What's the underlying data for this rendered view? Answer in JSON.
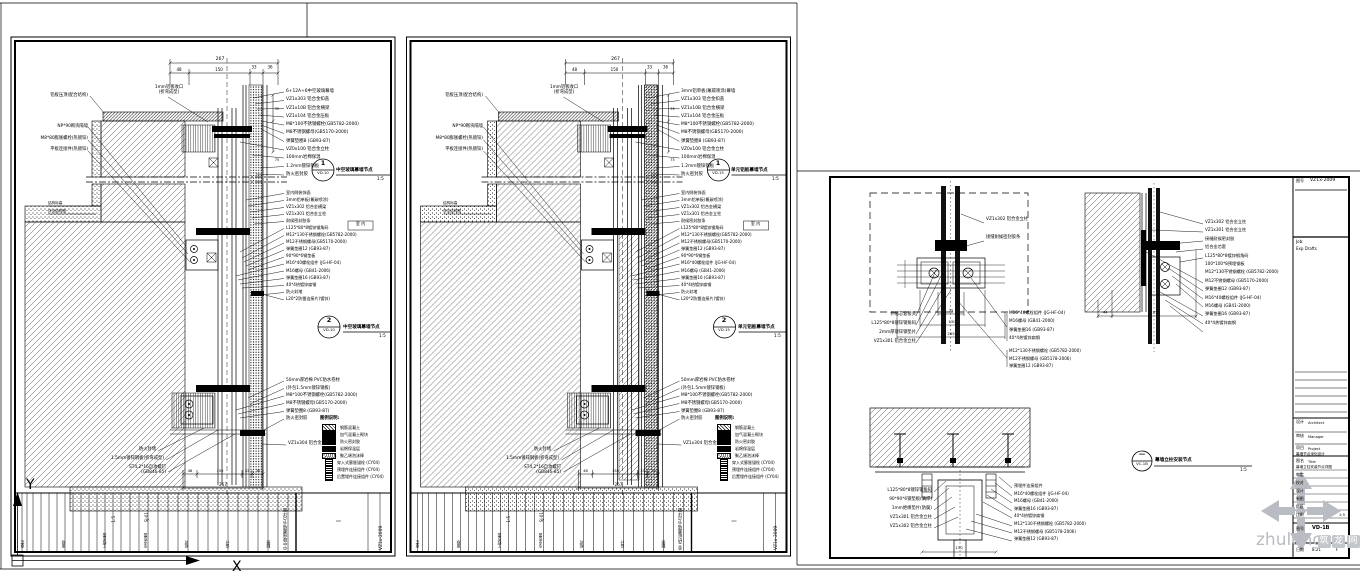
{
  "colors": {
    "line": "#000000",
    "watermark_grey": "#b9bcc2",
    "paper": "#ffffff"
  },
  "watermark": {
    "text": "zhulong",
    "suffix_chars": [
      "筑",
      "龙",
      "网"
    ]
  },
  "ucs": {
    "x_label": "X",
    "y_label": "Y"
  },
  "sheet_dims": {
    "top_total": "267",
    "segs": [
      "48",
      "150",
      "33",
      "36"
    ],
    "bottom_total": "267",
    "bottom_segs": [
      "48",
      "150",
      "33",
      "36"
    ],
    "side": [
      "35",
      "75"
    ]
  },
  "legend": {
    "title": "图例说明:",
    "items": [
      {
        "swatch": "hatch",
        "label": "钢筋混凝土"
      },
      {
        "swatch": "solid",
        "label": "加气混凝土砌块"
      },
      {
        "swatch": "solid",
        "label": "防火密封胶"
      },
      {
        "swatch": "solid",
        "label": "岩棉保温层"
      },
      {
        "swatch": "dots",
        "label": "聚乙烯泡沫棒"
      },
      {
        "swatch": "anchor",
        "label": "穿入式膨胀锚栓 (CY04)"
      },
      {
        "swatch": "anchor",
        "label": "预埋件连接组件 (CY04)"
      },
      {
        "swatch": "anchor",
        "label": "后置埋件连接组件 (CY04)"
      }
    ]
  },
  "sheet1": {
    "label_top": "1mm铝板收口\n(折弯成型)",
    "labels_left": [
      "铝板压顶(配合结构)",
      "NP*90砌块隔墙",
      "M8*80膨胀螺栓(热镀锌)",
      "平板连接件(热镀锌)"
    ],
    "labels_level": [
      "结构标高",
      "详见结构图"
    ],
    "labels_bottom": [
      "防火封堵",
      "1.5mm镀锌钢板(折弯成型)",
      "ST4.2*16自攻螺钉\n(GB846-85)"
    ],
    "labels_right_top": [
      "6+12A+6中空玻璃幕墙",
      "VZ1x303 铝合金扣盖",
      "VZ1x10B 铝合金横梁",
      "VZ1x104 铝合金压板",
      "M8*100不锈钢螺栓(GB5782-2000)",
      "M8不锈钢螺母(GB5170-2000)",
      "弹簧垫圈8 (GB93-87)",
      "VZ0x100 铝合金立柱",
      "100mm岩棉保温",
      "1.2mm镀锌钢板",
      "防火密封胶"
    ],
    "labels_right_mid": [
      "室内侧装饰面",
      "3mm铝单板(氟碳喷涂)",
      "VZ1x302 铝合金横梁",
      "VZ1x301 铝合金立柱",
      "耐候密封胶条",
      "L125*80*8镀锌钢角码",
      "M12*130不锈钢螺栓(GB5782-2000)",
      "M12不锈钢螺母(GB5170-2000)",
      "弹簧垫圈12 (GB93-87)",
      "90*90*6钢垫板",
      "M16*40螺栓组件 (JG-HF-04)",
      "M16螺母 (GB41-2006)",
      "弹簧垫圈16 (GB93-87)",
      "40*4热镀锌扁钢",
      "防火封堵",
      "L20*2防雷连接片(镀锌)"
    ],
    "labels_right_bottom": [
      "50mm厚岩棉 PVC防水卷材",
      "(外包1.5mm镀锌钢板)",
      "M8*100不锈钢螺栓(GB5782-2000)",
      "M8不锈钢螺母(GB5170-2000)",
      "弹簧垫圈8 (GB93-87)",
      "防火密封胶"
    ],
    "label_cap": "VZ1x304 铝合金扣盖",
    "room_tag": "室 内",
    "callouts": [
      {
        "num": "1",
        "ref": "VD-10",
        "title": "中空玻璃幕墙节点",
        "scale": "1:5"
      },
      {
        "num": "2",
        "ref": "VD-10",
        "title": "中空玻璃幕墙节点",
        "scale": "1:5"
      }
    ],
    "strip": {
      "fields": [
        "审定",
        "审核",
        "工程负责",
        "专业负责",
        "校对",
        "设计",
        "制图"
      ],
      "scale": "1:5",
      "code": "SJ-01",
      "title": "中空玻璃幕墙节点详图",
      "no": "VZ1x-2009"
    }
  },
  "sheet2": {
    "label_top": "1mm铝板收口\n(折弯成型)",
    "labels_left": [
      "铝板压顶(配合结构)",
      "NP*90砌块隔墙",
      "M8*80膨胀螺栓(热镀锌)",
      "平板连接件(热镀锌)"
    ],
    "labels_level": [
      "结构标高",
      "详见结构图"
    ],
    "labels_bottom": [
      "防火封堵",
      "1.5mm镀锌钢板(折弯成型)",
      "ST4.2*16自攻螺钉\n(GB846-85)"
    ],
    "labels_right_top": [
      "3mm铝单板(氟碳喷涂)幕墙",
      "VZ1x303 铝合金扣盖",
      "VZ1x10B 铝合金横梁",
      "VZ1x104 铝合金压板",
      "M8*100不锈钢螺栓(GB5782-2000)",
      "M8不锈钢螺母(GB5170-2000)",
      "弹簧垫圈8 (GB93-87)",
      "VZ0x100 铝合金立柱",
      "100mm岩棉保温",
      "1.2mm镀锌钢板",
      "防火密封胶"
    ],
    "labels_right_mid": [
      "室内侧装饰面",
      "3mm铝单板(氟碳喷涂)",
      "VZ1x302 铝合金横梁",
      "VZ1x301 铝合金立柱",
      "耐候密封胶条",
      "L125*80*8镀锌钢角码",
      "M12*130不锈钢螺栓(GB5782-2000)",
      "M12不锈钢螺母(GB5170-2000)",
      "弹簧垫圈12 (GB93-87)",
      "90*90*6钢垫板",
      "M16*40螺栓组件 (JG-HF-04)",
      "M16螺母 (GB41-2006)",
      "弹簧垫圈16 (GB93-87)",
      "40*4热镀锌扁钢",
      "防火封堵",
      "L20*2防雷连接片(镀锌)"
    ],
    "labels_right_bottom": [
      "50mm厚岩棉 PVC防水卷材",
      "(外包1.5mm镀锌钢板)",
      "M8*100不锈钢螺栓(GB5782-2000)",
      "M8不锈钢螺母(GB5170-2000)",
      "弹簧垫圈8 (GB93-87)",
      "防火密封胶"
    ],
    "label_cap": "VZ1x304 铝合金扣盖",
    "room_tag": "室 内",
    "callouts": [
      {
        "num": "1",
        "ref": "VD-15",
        "title": "单元铝板幕墙节点",
        "scale": "1:5"
      },
      {
        "num": "2",
        "ref": "VD-15",
        "title": "单元铝板幕墙节点",
        "scale": "1:5"
      }
    ],
    "strip": {
      "fields": [
        "审定",
        "审核",
        "工程负责",
        "专业负责",
        "校对",
        "设计",
        "制图"
      ],
      "scale": "1:5",
      "code": "SJ-01",
      "title": "单元铝板幕墙节点详图",
      "no": "VZ1x-2009"
    }
  },
  "sheet3": {
    "detailA": {
      "labels_left": [
        "伸缩芯套接头",
        "L125*80*8镀锌钢角码",
        "2mm厚镀锌钢垫片",
        "VZ1x301 铝合金立柱"
      ],
      "labels_right": [
        "VZ1x302 铝合金立柱",
        "接缝耐候密封胶条"
      ],
      "bolts1": [
        "M16*40螺栓组件 (JG-HF-04)",
        "M16螺母 (GB41-2000)",
        "弹簧垫圈16 (GB93-87)",
        "40*4热镀锌扁钢"
      ],
      "bolts2": [
        "M12*130不锈钢螺栓 (GB5782-2000)",
        "M12不锈钢螺母 (GB5178-2006)",
        "弹簧垫圈12 (GB93-87)"
      ],
      "dims": [
        "75",
        "130",
        "285"
      ]
    },
    "detailB": {
      "labels": [
        "VZ1x302 铝合金立柱",
        "VZ1x301 铝合金立柱",
        "接缝耐候密封胶",
        "铝合金芯套",
        "L125*80*8镀锌钢角码",
        "100*100*8预埋钢板",
        "M12*130不锈钢螺栓 (GB5782-2000)",
        "M12不锈钢螺母 (GB5170-2000)",
        "弹簧垫圈12 (GB93-87)",
        "M16*40螺栓组件 (JG-HF-04)",
        "M16螺母 (GB41-2000)",
        "弹簧垫圈16 (GB93-87)",
        "40*4热镀锌扁钢"
      ],
      "dims": [
        "44",
        "185"
      ]
    },
    "detailC": {
      "labels_left": [
        "L125*80*8镀锌钢角码",
        "90*90*6钢垫板(满焊)",
        "1mm绝缘垫片(防腐)",
        "VZ1x301 铝合金立柱",
        "VZ1x302 铝合金立柱"
      ],
      "labels_right": [
        "预埋件连接组件",
        "M16*40螺栓组件 (JG-HF-04)",
        "M16螺母 (GB41-2000)",
        "弹簧垫圈16 (GB93-87)",
        "40*4热镀锌扁钢",
        "M12*130不锈钢螺栓 (GB5782-2000)",
        "M12不锈钢螺母 (GB5178-2006)",
        "弹簧垫圈12 (GB93-87)"
      ],
      "dim": "130"
    },
    "callout": {
      "num": "—",
      "ref": "VC-1B",
      "title": "幕墙立柱安装节点",
      "scale": "1:5"
    },
    "titleblock": {
      "doc_label": "图号",
      "doc_no": "VZ1x-2009",
      "job_lines": [
        "Job:",
        "Exp Drafts"
      ],
      "r1l": "设计",
      "r1s": "Architect",
      "r2l": "审核",
      "r2s": "Manager",
      "r3l": "项目",
      "r3s": "Project",
      "r3v": "幕墙节点深化设计",
      "r4l": "图名",
      "r4s": "Title",
      "r4v": "幕墙立柱安装节点详图",
      "small_rows": [
        {
          "l": "审定",
          "v": ""
        },
        {
          "l": "校对",
          "v": ""
        },
        {
          "l": "设计",
          "v": ""
        },
        {
          "l": "制图",
          "v": ""
        },
        {
          "l": "阶段",
          "v": ""
        },
        {
          "l": "比例",
          "v": "1:5"
        }
      ],
      "no_label": "图号",
      "drawing_no": "VD-1B",
      "date_label": "日期",
      "date": "8.21",
      "rev": "F"
    }
  }
}
